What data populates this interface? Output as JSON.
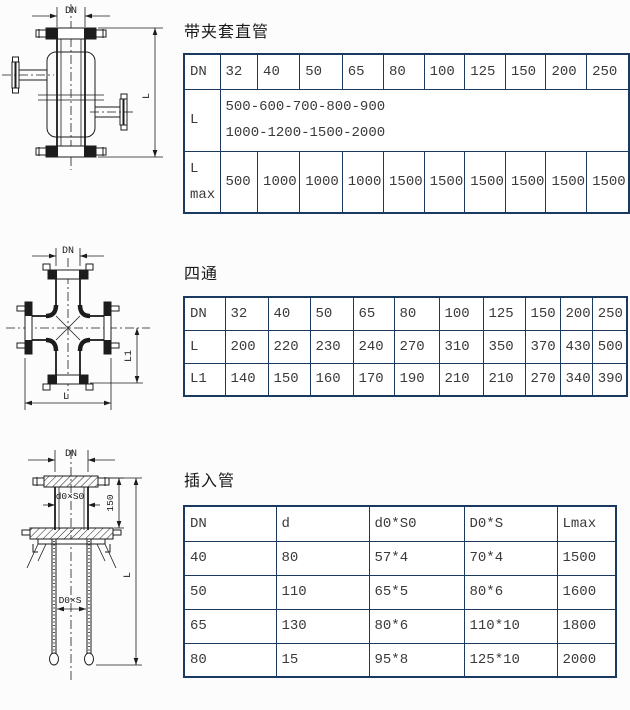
{
  "page": {
    "bg": "#fcfcfc",
    "table_border_color": "#1b3a60",
    "text_color": "#3a3a3a",
    "line_color": "#1c1c1c"
  },
  "sections": {
    "jacketed": {
      "title": "带夹套直管",
      "drawing": {
        "dn": "DN",
        "l": "L"
      },
      "table": {
        "dn_row": [
          "DN",
          "32",
          "40",
          "50",
          "65",
          "80",
          "100",
          "125",
          "150",
          "200",
          "250"
        ],
        "l_label": "L",
        "l_line1": "500-600-700-800-900",
        "l_line2": "1000-1200-1500-2000",
        "lmax_label_1": "L",
        "lmax_label_2": "max",
        "lmax_values": [
          "500",
          "1000",
          "1000",
          "1000",
          "1500",
          "1500",
          "1500",
          "1500",
          "1500",
          "1500"
        ]
      }
    },
    "cross": {
      "title": "四通",
      "drawing": {
        "dn": "DN",
        "l1": "L1",
        "l": "L"
      },
      "table": {
        "rows": [
          [
            "DN",
            "32",
            "40",
            "50",
            "65",
            "80",
            "100",
            "125",
            "150",
            "200",
            "250"
          ],
          [
            "L",
            "200",
            "220",
            "230",
            "240",
            "270",
            "310",
            "350",
            "370",
            "430",
            "500"
          ],
          [
            "L1",
            "140",
            "150",
            "160",
            "170",
            "190",
            "210",
            "210",
            "270",
            "340",
            "390"
          ]
        ]
      }
    },
    "insert": {
      "title": "插入管",
      "drawing": {
        "dn": "DN",
        "d0s0": "d0×S0",
        "dim150": "150",
        "d0s": "D0×S",
        "l": "L"
      },
      "table": {
        "rows": [
          [
            "DN",
            "d",
            "d0*S0",
            "D0*S",
            "Lmax"
          ],
          [
            "40",
            "80",
            "57*4",
            "70*4",
            "1500"
          ],
          [
            "50",
            "110",
            "65*5",
            "80*6",
            "1600"
          ],
          [
            "65",
            "130",
            "80*6",
            "110*10",
            "1800"
          ],
          [
            "80",
            "15",
            "95*8",
            "125*10",
            "2000"
          ]
        ]
      }
    }
  }
}
